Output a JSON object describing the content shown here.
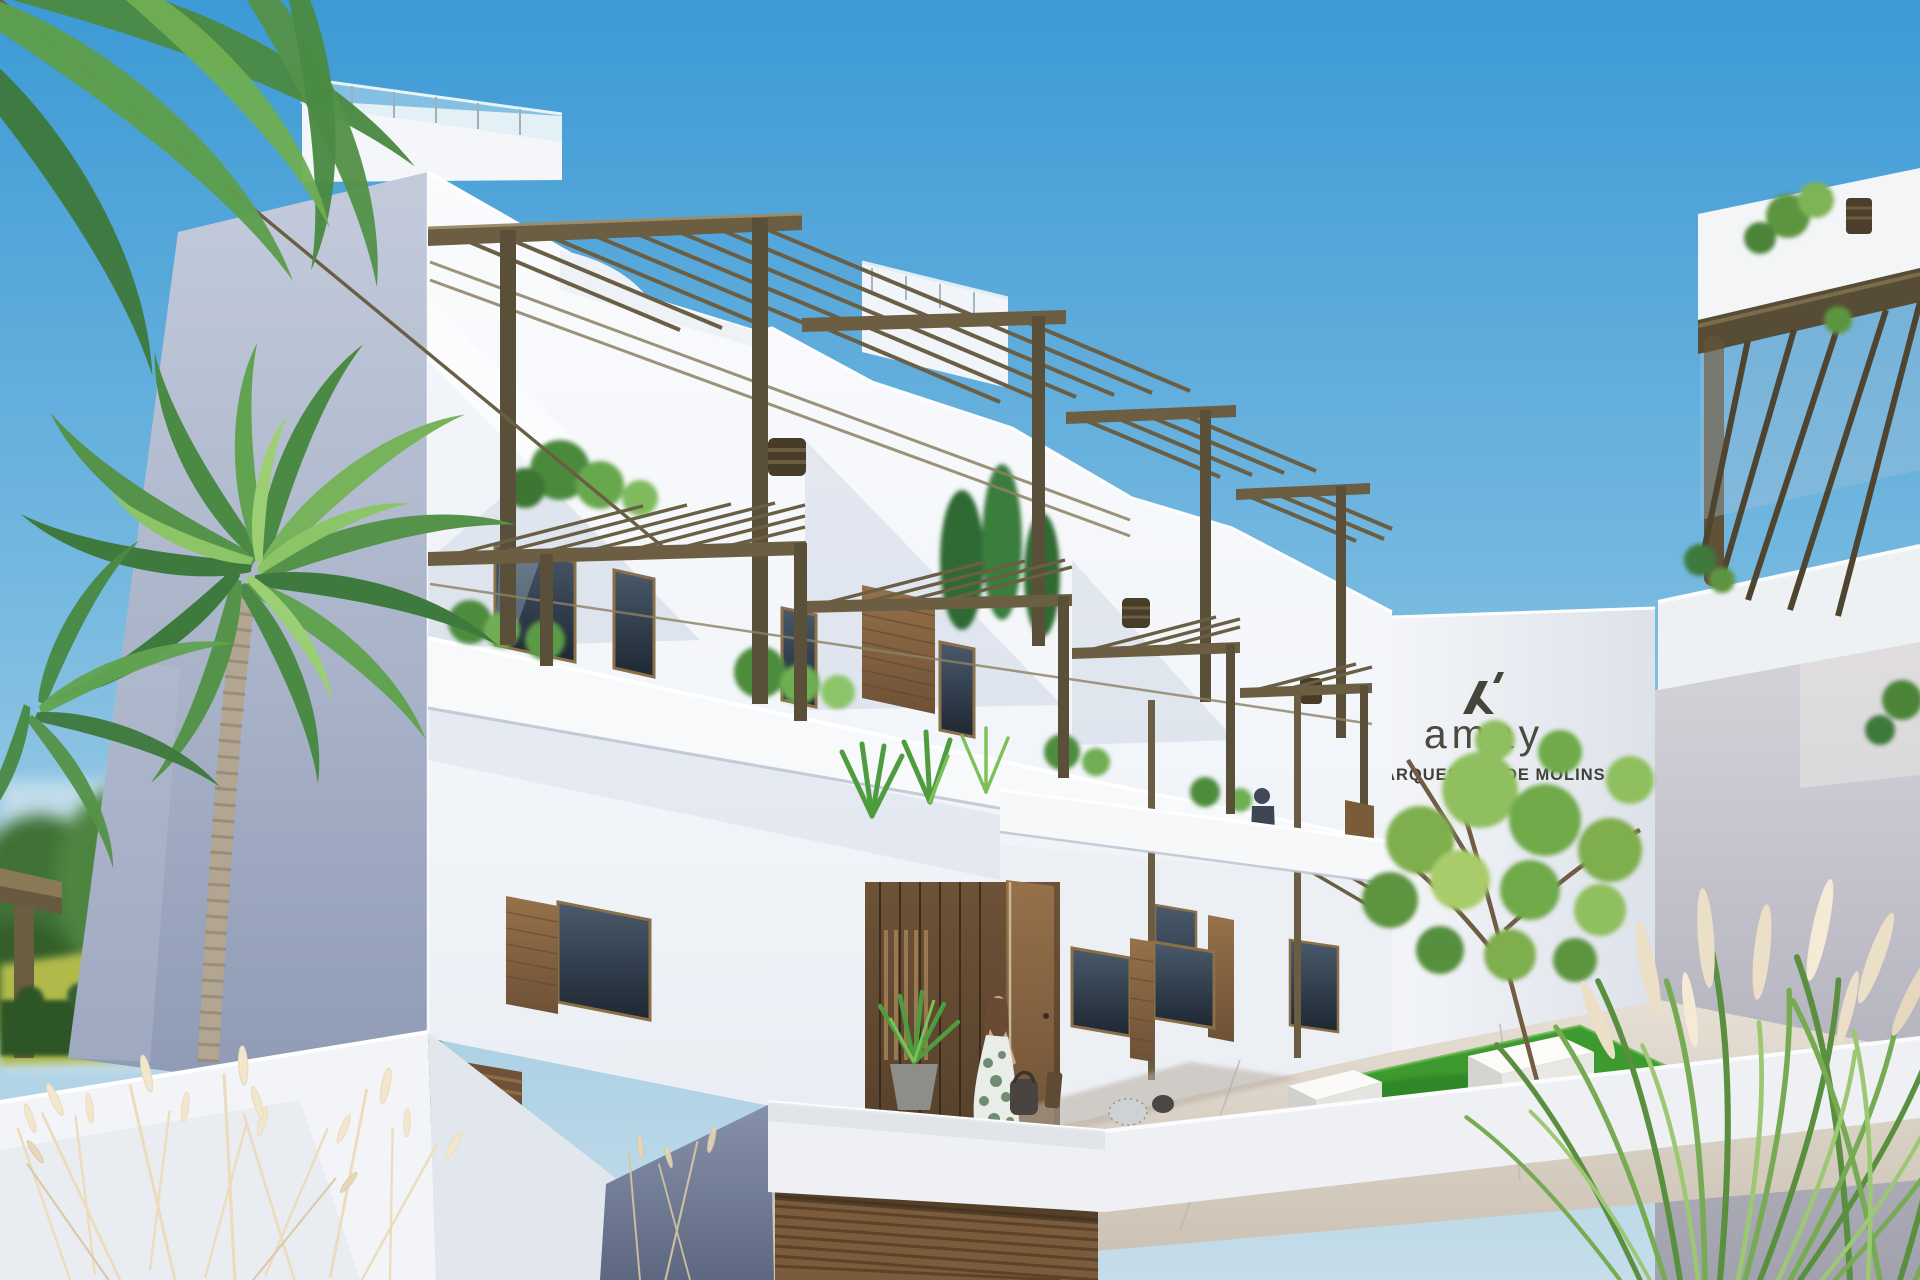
{
  "sign": {
    "brand": "amay",
    "project_name": "MARQUESADO DE MOLINS",
    "logo": "amay-monogram",
    "text_color": "#45453b"
  },
  "scene": {
    "type": "3d-architectural-exterior-render",
    "setting": "Modern white Mediterranean apartment complex with stepped roof terraces, bronze pergolas, courtyard garden and palm trees under a clear blue sky",
    "objects": [
      {
        "name": "main-residential-building",
        "description": "stepped white block, three levels, roof terraces with glass balustrades and bronze pergolas"
      },
      {
        "name": "entrance-portal",
        "description": "recessed double-height entry with wood cladding, slatted screen, open bronze door and potted palm"
      },
      {
        "name": "courtyard",
        "description": "tiled patio with lawn, two white cube benches and a young tree"
      },
      {
        "name": "sign-wall",
        "description": "white wall panel bearing the amay logo and project name"
      },
      {
        "name": "right-building",
        "description": "neighbouring white block with bronze pergola and rooftop planting"
      },
      {
        "name": "garage-ramp",
        "description": "driveway ramp leading down to a wooden slatted garage door"
      },
      {
        "name": "palm-trees",
        "description": "tall palms framing the left side of the view"
      },
      {
        "name": "ornamental-grasses",
        "description": "dry plumed grasses in the foreground corners"
      }
    ],
    "figures": [
      {
        "name": "woman-with-bag",
        "description": "woman in a green-and-white summer dress carrying a dark handbag walking toward the entrance"
      },
      {
        "name": "man-on-walkway",
        "description": "man standing on the first-floor walkway"
      }
    ]
  },
  "colors": {
    "sky_top": "#3d9ad5",
    "sky_horizon": "#bcd9e7",
    "wall_sunlit": "#f5f7fa",
    "wall_shaded": "#9aa5bd",
    "pergola_bronze": "#6b5e43",
    "wood_cladding": "#86633f",
    "garage_door": "#7a5c3d",
    "lawn_green": "#3c9a2e",
    "palm_green": "#4f8f46",
    "grass_plume": "#ecdfc7",
    "pavement": "#d8cfc4",
    "sign_text": "#45453b"
  }
}
